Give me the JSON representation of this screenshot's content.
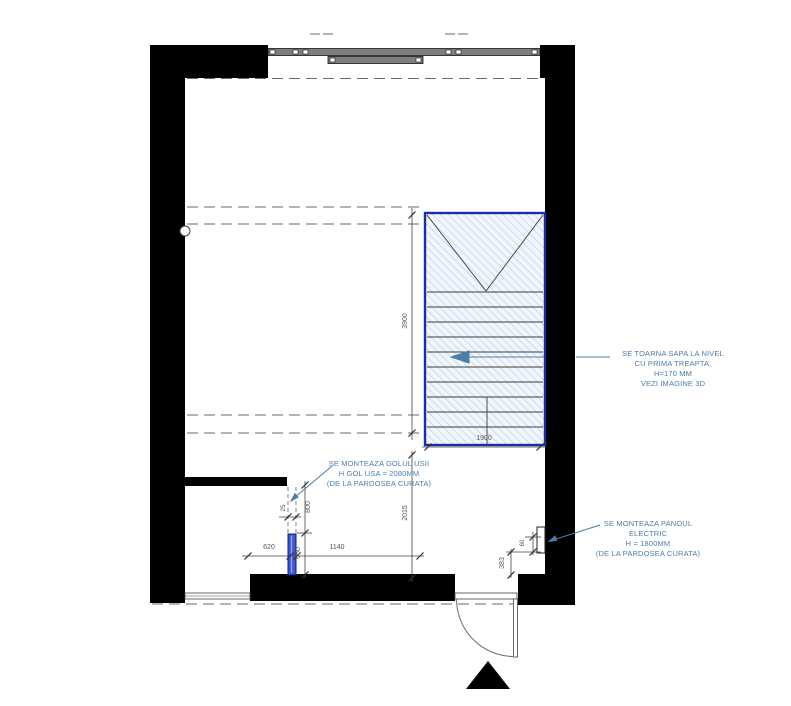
{
  "plan": {
    "title": "floor plan with staircase detail",
    "notes": {
      "screed": [
        "SE TOARNA SAPA LA NIVEL",
        "CU PRIMA TREAPTA,",
        "H=170 MM",
        "VEZI IMAGINE 3D"
      ],
      "door_opening": [
        "SE MONTEAZA GOLUL USII",
        "H GOL USA = 2080MM",
        "(DE LA PARDOSEA CURATA)"
      ],
      "electric_panel": [
        "SE MONTEAZA PANOUL",
        "ELECTRIC",
        "H = 1800MM",
        "(DE LA PARDOSEA CURATA)"
      ]
    },
    "dimensions": {
      "stair_width": "1900",
      "stair_run": "3900",
      "lower_hall": "2015",
      "left_offset": "620",
      "door_leaf": "660",
      "door_opening_height": "800",
      "jamb_gap": "25",
      "bottom_span": "1140",
      "panel_offset": "383",
      "panel_size": "60"
    },
    "colors": {
      "wall": "#000000",
      "stair_border": "#1b2fa0",
      "stair_hatch_line": "#b3c7e6",
      "stair_hatch_bg": "#f1f5fc",
      "door_element_fill": "#3f58cf",
      "annotation": "#4e7da8",
      "dimension_line": "#444444"
    }
  }
}
